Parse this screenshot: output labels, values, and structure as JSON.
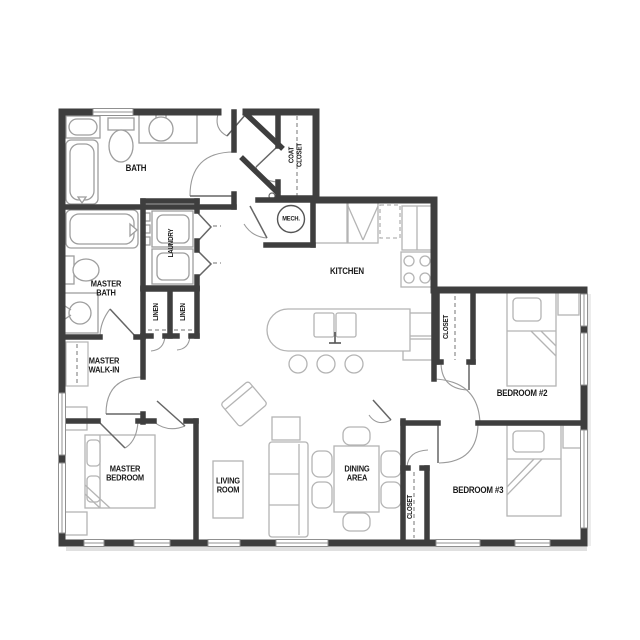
{
  "plan": {
    "labels": {
      "bath": "BATH",
      "coat_closet": [
        "COAT",
        "CLOSET"
      ],
      "mech": "MECH.",
      "laundry": "LAUNDRY",
      "master_bath": [
        "MASTER",
        "BATH"
      ],
      "linen_left": "LINEN",
      "linen_right": "LINEN",
      "master_walk_in": [
        "MASTER",
        "WALK-IN"
      ],
      "kitchen": "KITCHEN",
      "bedroom2_closet": "CLOSET",
      "bedroom2": "BEDROOM #2",
      "master_bedroom": [
        "MASTER",
        "BEDROOM"
      ],
      "living_room": [
        "LIVING",
        "ROOM"
      ],
      "dining_area": [
        "DINING",
        "AREA"
      ],
      "bedroom3_closet": "CLOSET",
      "bedroom3": "BEDROOM #3"
    },
    "colors": {
      "background": "#ffffff",
      "wall": "#3e3e3e",
      "window": "#909090",
      "door_arc": "#9a9a9a",
      "fixture": "#9e9e9e",
      "furniture": "#b4b4b4",
      "label_text": "#1a1a1a"
    }
  }
}
